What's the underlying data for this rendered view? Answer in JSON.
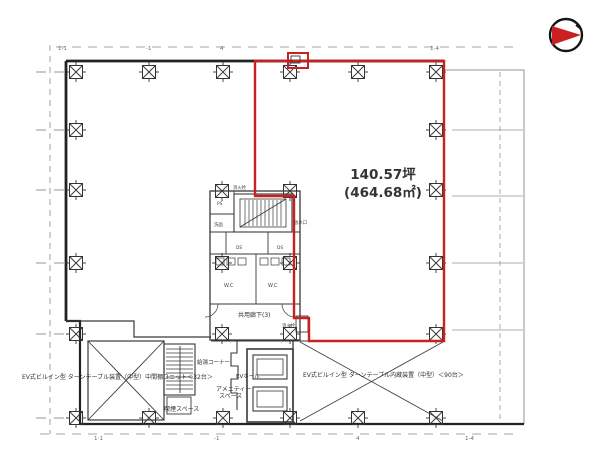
{
  "colors": {
    "highlight": "#cc2020",
    "wall": "#232323",
    "faint": "#8d949b"
  },
  "area": {
    "line1": "140.57坪",
    "line2": "(464.68㎡)"
  },
  "labels": {
    "parking_left": "EV式ビルイン型 ターンテーブル装置（中型）中間棚ユニット＜32台＞",
    "parking_right": "EV式ビルイン型 ターンテーブル内蔵装置（中型）＜90台＞",
    "corridor": "共用廊下(3)",
    "hot_water": "給湯コーナー",
    "amenity1": "アメニティー",
    "amenity2": "スペース",
    "smoking": "喫煙スペース",
    "ev_hall": "EVホール",
    "fire_top": "消火栓",
    "fire_bottom": "消火栓",
    "water_outlet": "放水口",
    "wc_left": "W.C",
    "wc_right": "W.C",
    "ds_left": "DS",
    "ds_right": "DS",
    "ps": "PS",
    "senmen": "洗面"
  },
  "grid": {
    "top": [
      "1-1",
      "-1",
      "4",
      "1-4"
    ],
    "bottom": [
      "1-1",
      "-1",
      "4",
      "1-4"
    ]
  }
}
